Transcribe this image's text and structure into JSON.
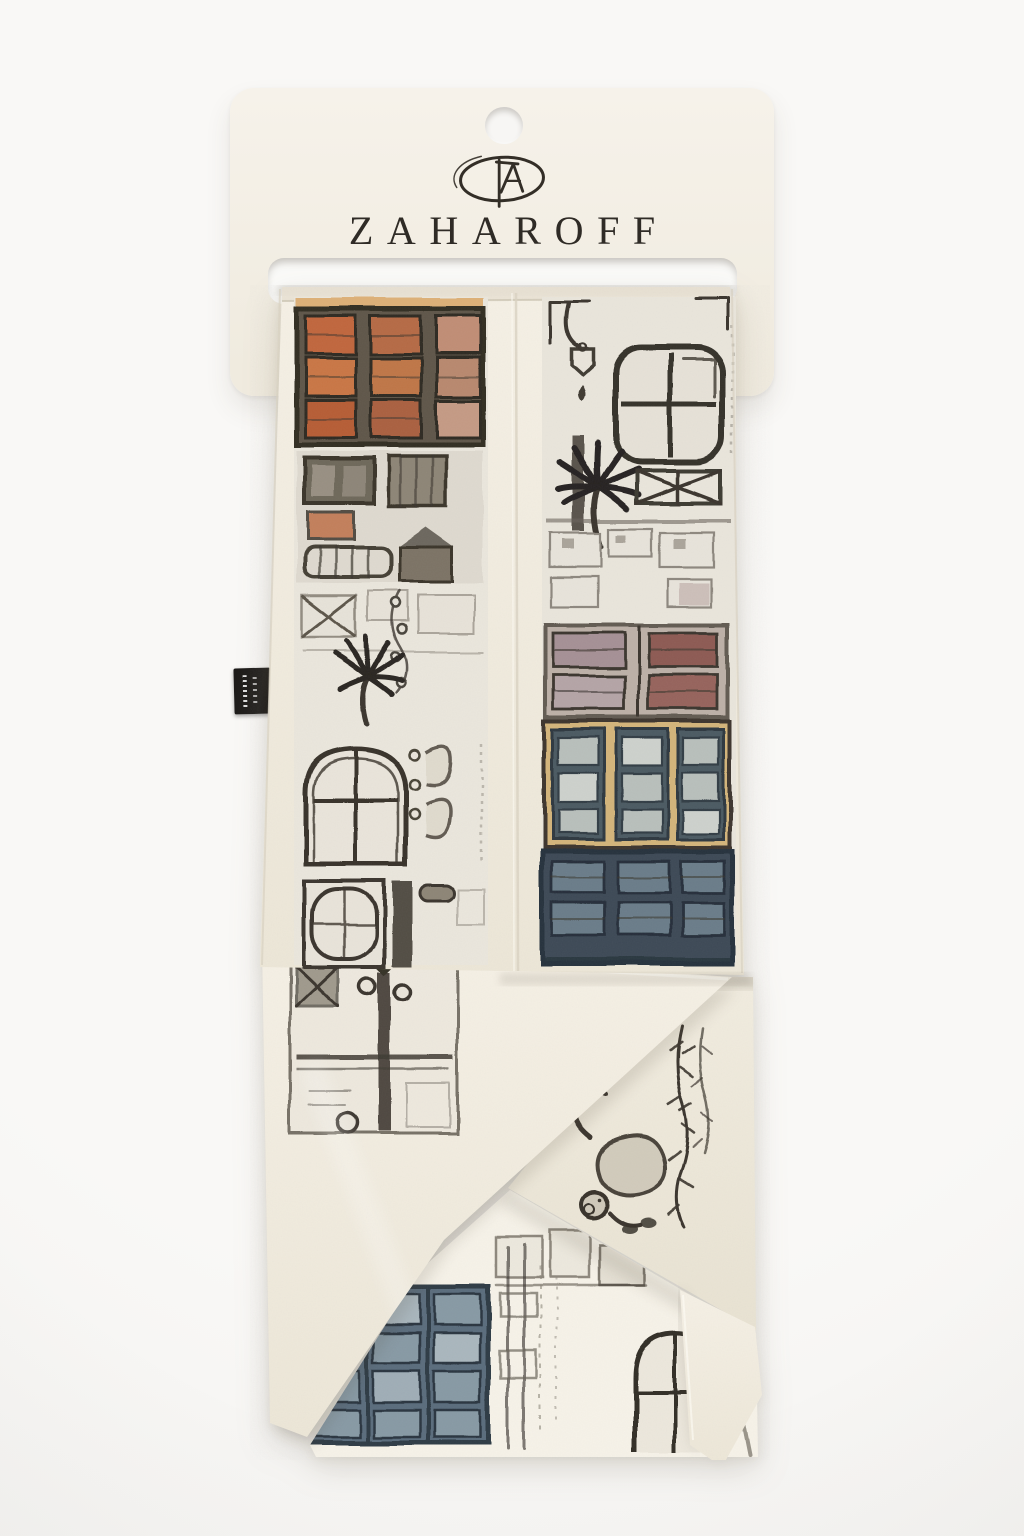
{
  "brand": {
    "name": "ZAHAROFF"
  },
  "logo": {
    "type": "hand-drawn oval monogram",
    "color": "#332e27"
  },
  "hanger_card": {
    "color": "#f4f0e7",
    "hang_hole": "round punched hole",
    "slot": "rounded rectangular cut-out holding the scarf"
  },
  "scarf": {
    "type": "printed silk twilly, folded with crossed pointed tails",
    "base_color": "#f1ecdf",
    "motifs": [
      "terracotta shuttered windows",
      "sketched balconies and facades",
      "palm trees",
      "hanging street lantern",
      "arched windows",
      "wrought-iron gate with round lamps",
      "monkey in hanging foliage",
      "ochre building with slate shutters",
      "navy window block",
      "slate-blue shutter block"
    ]
  },
  "care_label": {
    "color": "#1a1817",
    "text_legible": false
  },
  "palette": {
    "background": "#f7f6f4",
    "charcoal_line": "#3b362e",
    "terracotta": "#c0663d",
    "ochre": "#d3b47a",
    "slate_blue": "#5a6c7c",
    "navy": "#3d4a57",
    "mauve": "#9a7a7c"
  }
}
